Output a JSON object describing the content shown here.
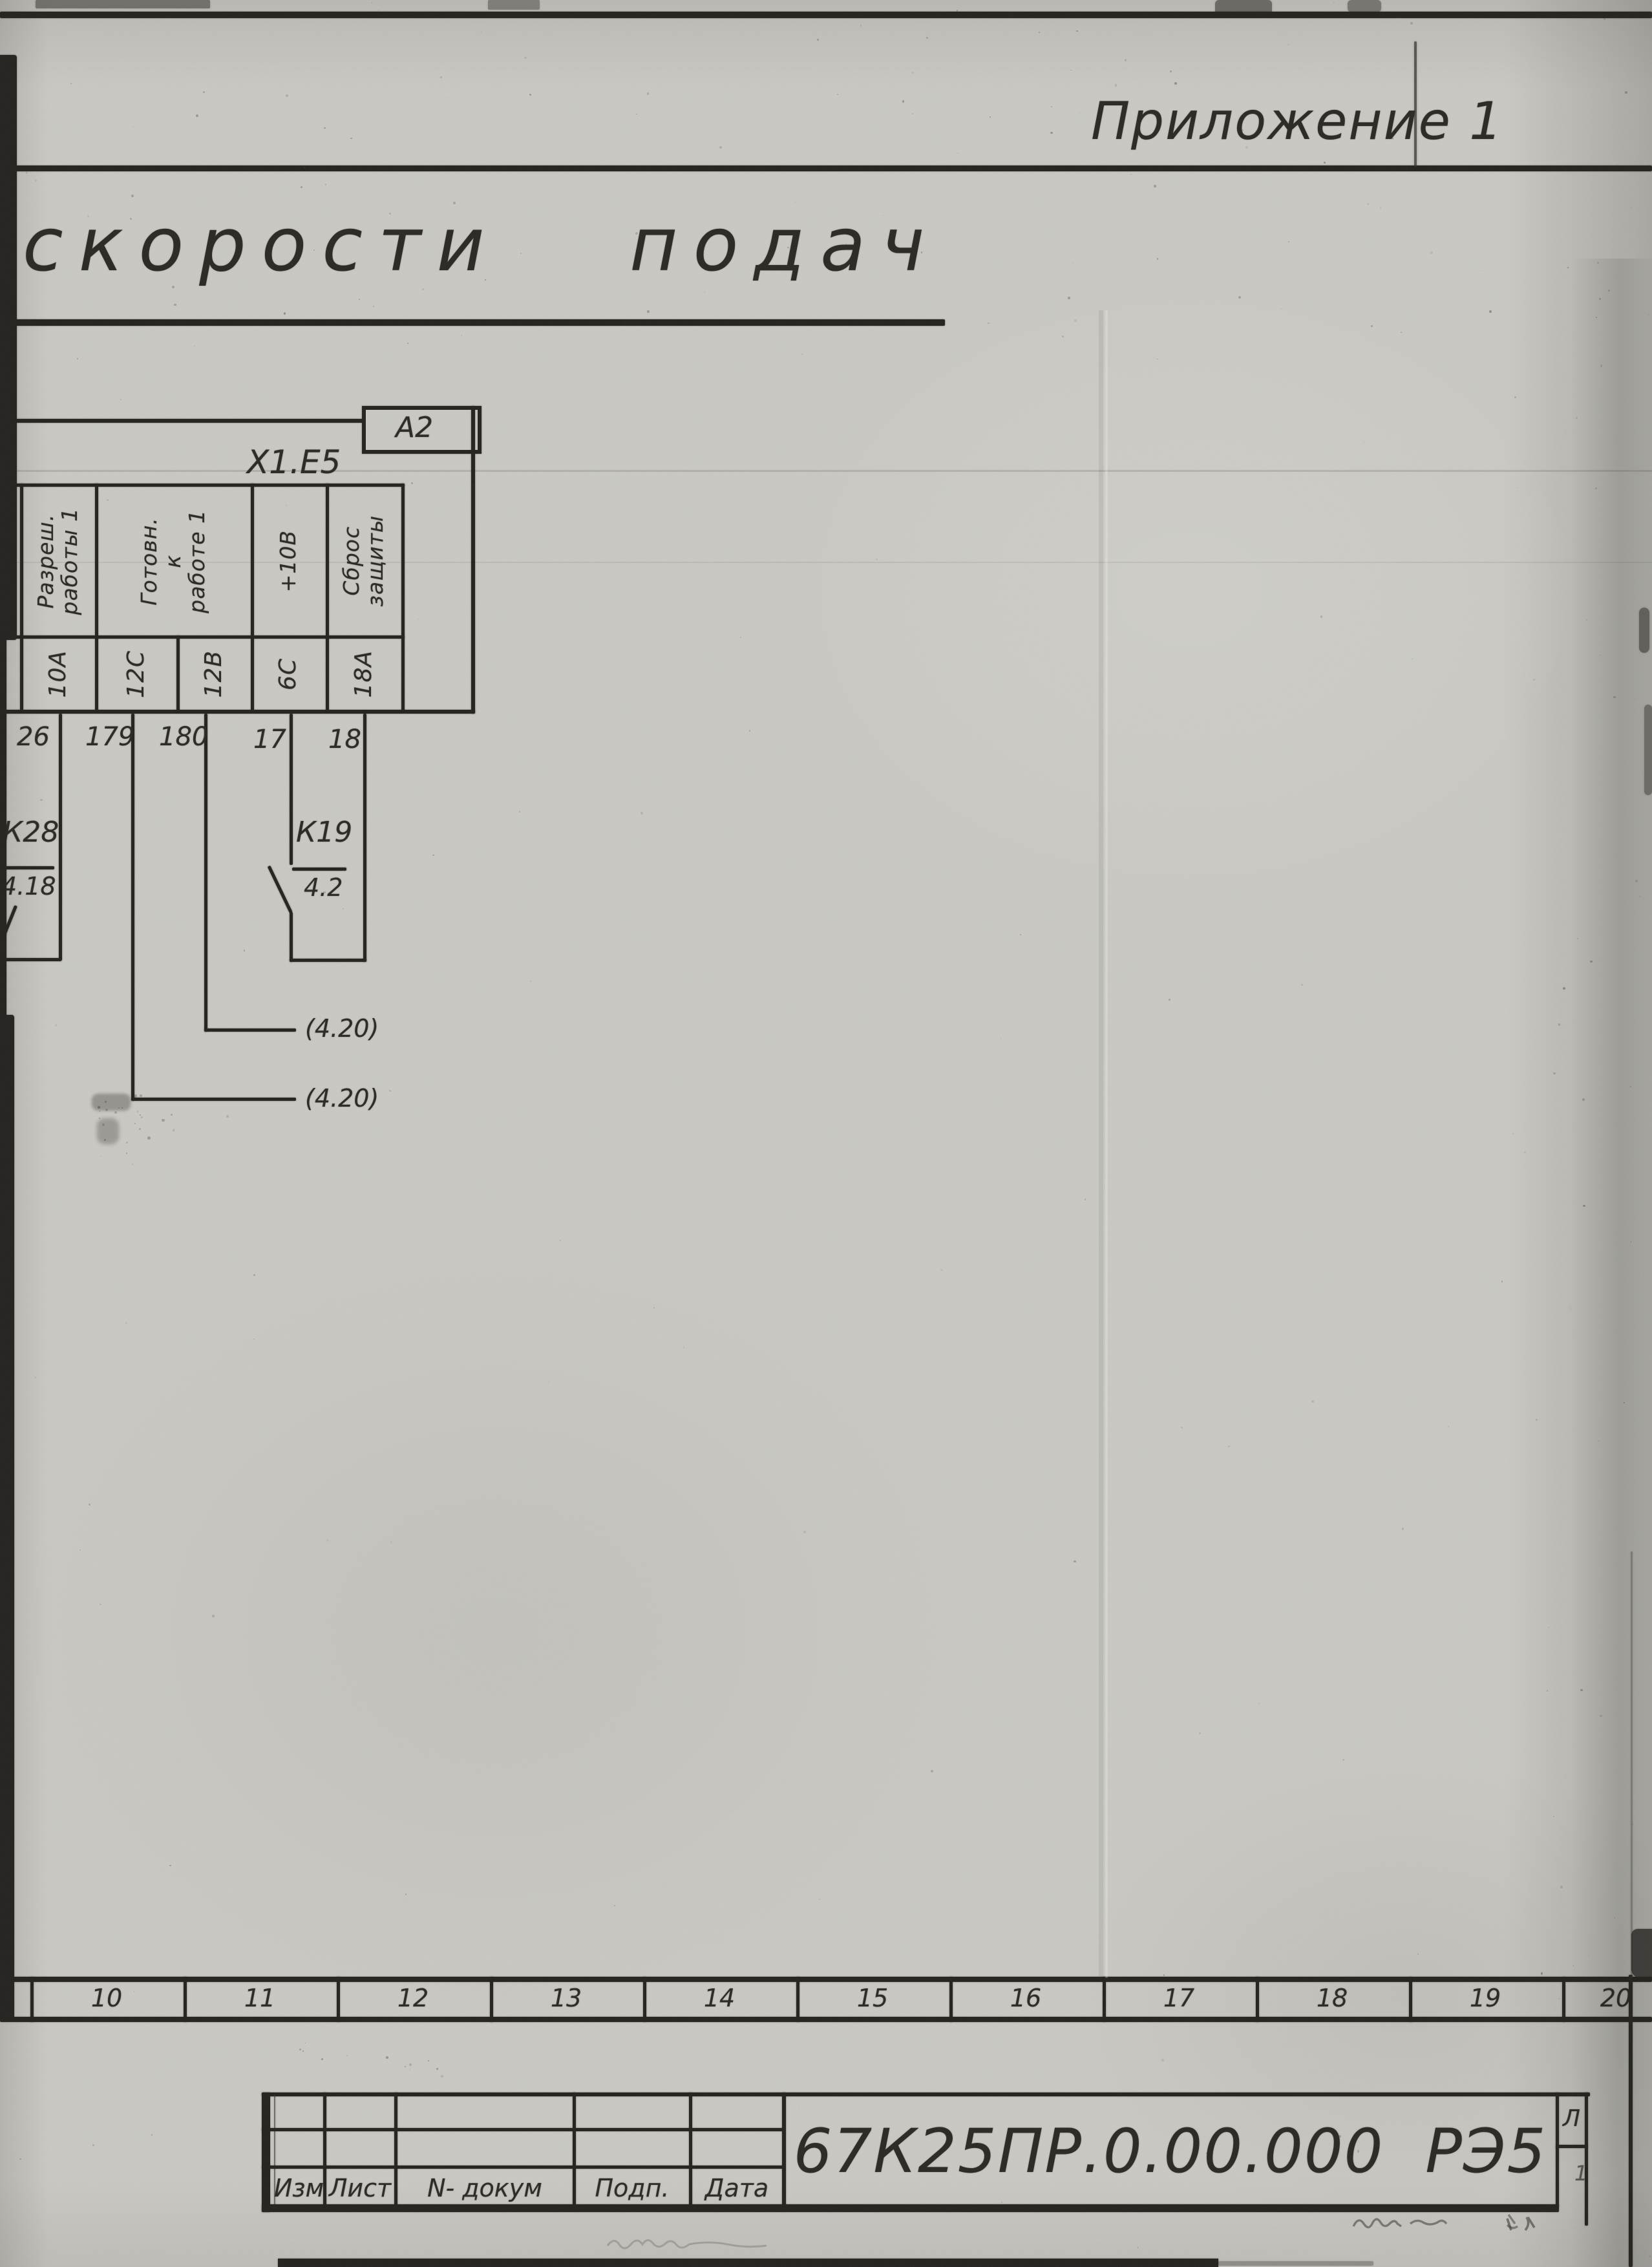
{
  "page": {
    "appendix_label": "Приложение 1",
    "title": "скорости  подач"
  },
  "schematic": {
    "block_ref": "А2",
    "connector_label": "X1.E5",
    "columns": [
      {
        "signal_lines": [
          "Разреш.",
          "работы 1"
        ],
        "pins": [
          {
            "pin": "10А",
            "wire": "26"
          }
        ]
      },
      {
        "signal_lines": [
          "Готовн.",
          "к",
          "работе 1"
        ],
        "pins": [
          {
            "pin": "12С",
            "wire": "179"
          },
          {
            "pin": "12В",
            "wire": "180"
          }
        ]
      },
      {
        "signal_lines": [
          "+10В"
        ],
        "pins": [
          {
            "pin": "6С",
            "wire": "17"
          }
        ]
      },
      {
        "signal_lines": [
          "Сброс",
          "защиты"
        ],
        "pins": [
          {
            "pin": "18А",
            "wire": "18"
          }
        ]
      }
    ],
    "contacts": [
      {
        "name": "К28",
        "sheet_ref": "4.18"
      },
      {
        "name": "К19",
        "sheet_ref": "4.2"
      }
    ],
    "off_sheet_refs": [
      "(4.20)",
      "(4.20)"
    ]
  },
  "ruler": {
    "numbers": [
      "10",
      "11",
      "12",
      "13",
      "14",
      "15",
      "16",
      "17",
      "18",
      "19",
      "20"
    ]
  },
  "title_block": {
    "doc_number": "67К25ПР.0.00.000  РЭ5",
    "column_labels": [
      "Изм",
      "Лист",
      "N- докум",
      "Подп.",
      "Дата"
    ],
    "corner_label": "Л",
    "corner_value": "1"
  }
}
